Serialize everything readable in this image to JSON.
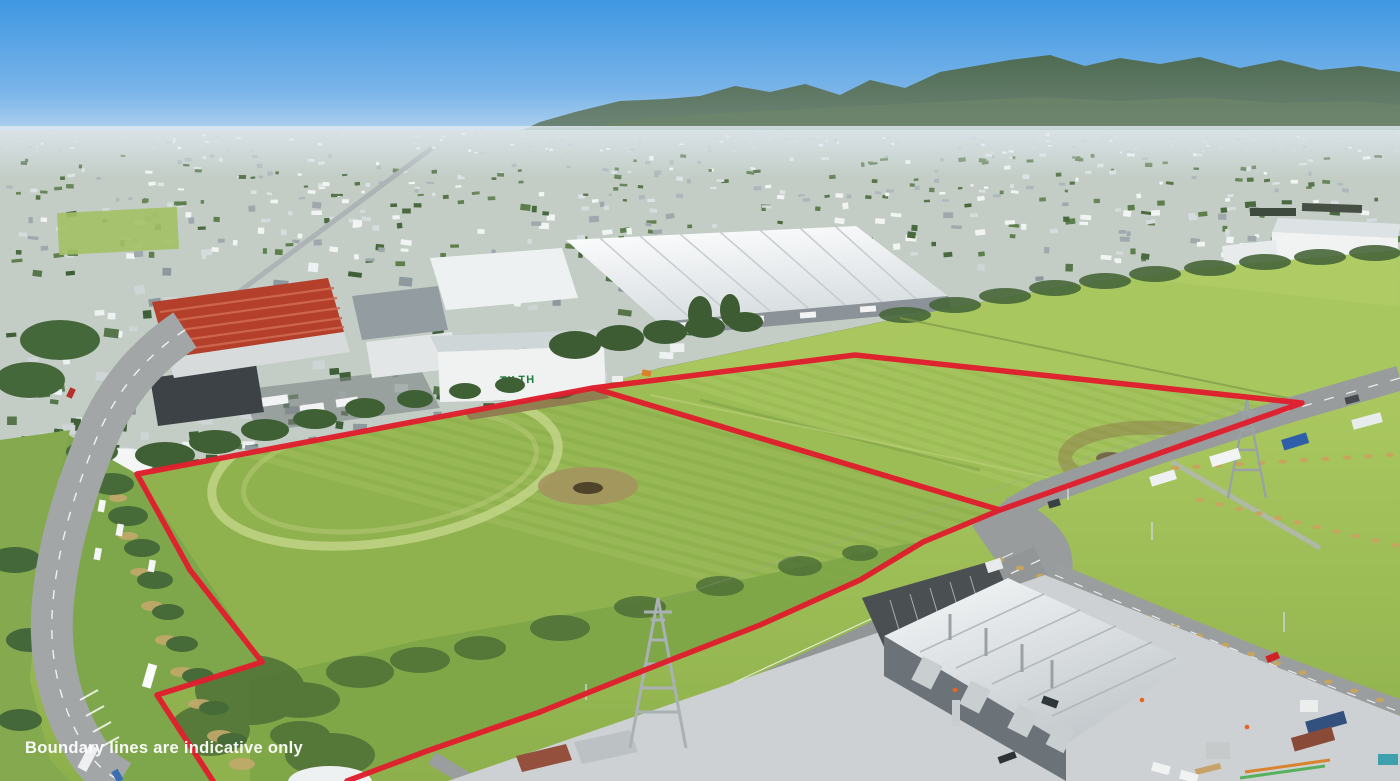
{
  "overlay": {
    "disclaimer": "Boundary lines are indicative only"
  },
  "signs": {
    "green_warehouse": "TILTH",
    "white_warehouse": "Direct"
  },
  "colors": {
    "boundary": "#df1f2d",
    "sky": "#3f97e2",
    "grass": "#9abc52",
    "haze": "#c7d1d6"
  }
}
